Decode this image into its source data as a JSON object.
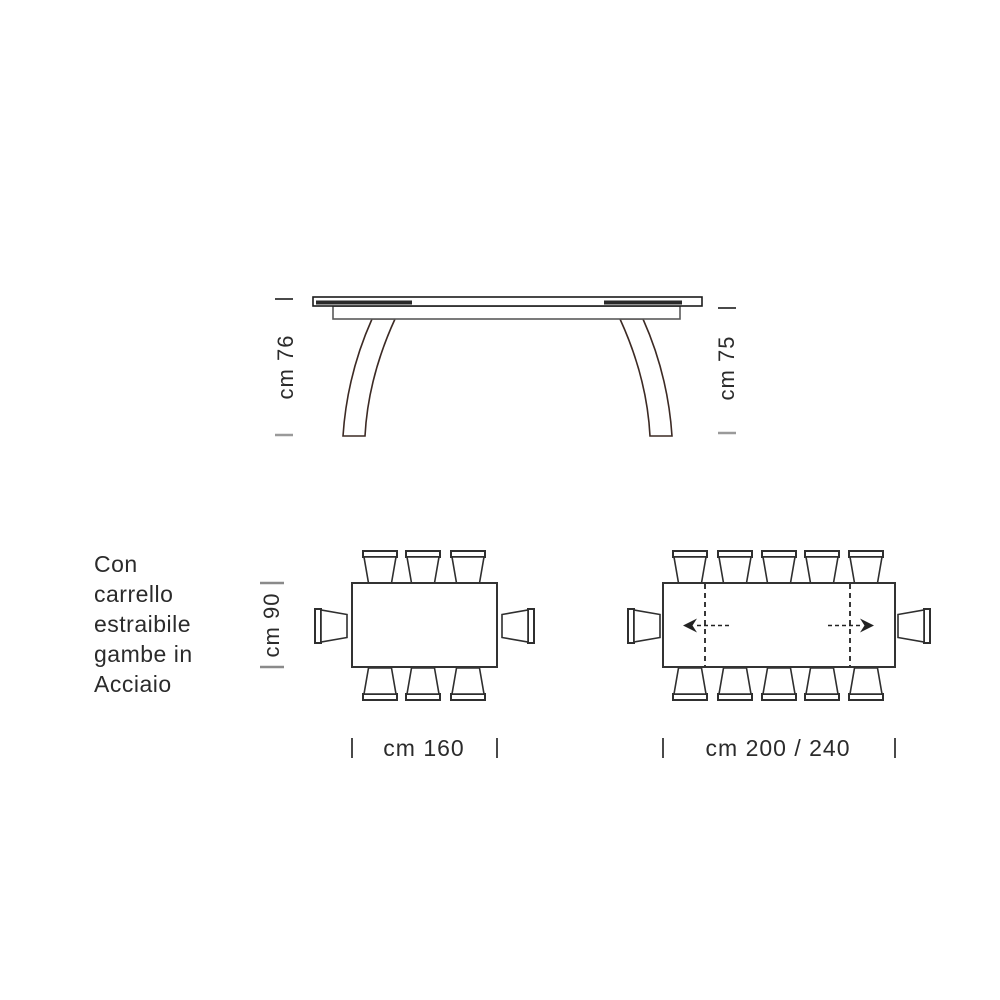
{
  "page": {
    "background": "#ffffff",
    "ink_color": "#2b2b2b",
    "line_color": "#2f2f2f",
    "leg_line_color": "#3c2a24",
    "light_tick_color": "#9a9a9a"
  },
  "note": {
    "text": "Con\ncarrello\nestraibile\ngambe in\nAcciaio"
  },
  "side_view": {
    "left_height_label": "cm 76",
    "right_height_label": "cm 75"
  },
  "plan_view_small": {
    "depth_label": "cm 90",
    "width_label": "cm 160",
    "seat_count": 8
  },
  "plan_view_large": {
    "width_label": "cm 200 / 240",
    "seat_count": 12,
    "has_extension_arrows": true
  }
}
